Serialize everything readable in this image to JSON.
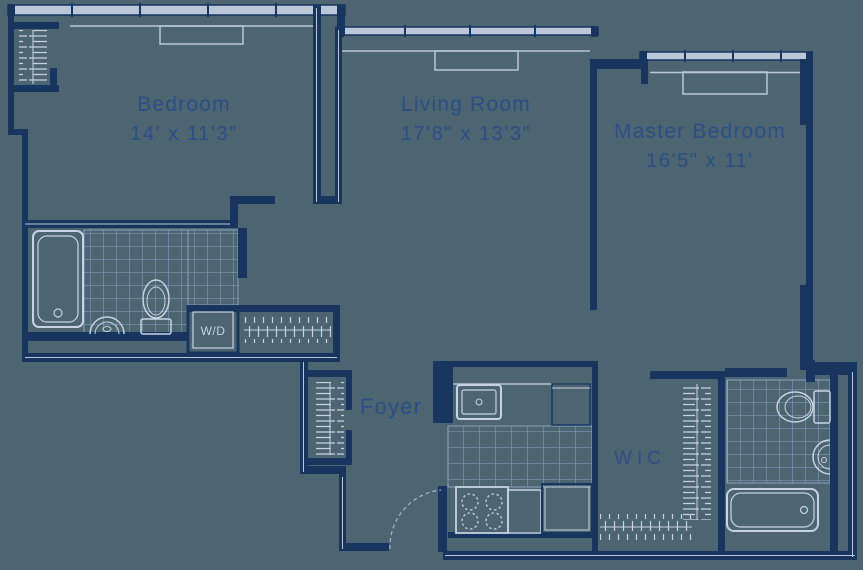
{
  "rooms": {
    "bedroom": {
      "name": "Bedroom",
      "dimensions": "14' x 11'3\""
    },
    "living_room": {
      "name": "Living Room",
      "dimensions": "17'8\" x 13'3\""
    },
    "master_bedroom": {
      "name": "Master Bedroom",
      "dimensions": "16'5\" x 11'"
    },
    "foyer": {
      "name": "Foyer"
    },
    "walk_in_closet": {
      "name": "WIC"
    },
    "washer_dryer": {
      "name": "W/D"
    }
  },
  "colors": {
    "background": "#4c6570",
    "wall": "#17355e",
    "fixture_line": "#c7d3e4",
    "tile_line": "#8da3bf",
    "label_text": "#2d4e87"
  }
}
